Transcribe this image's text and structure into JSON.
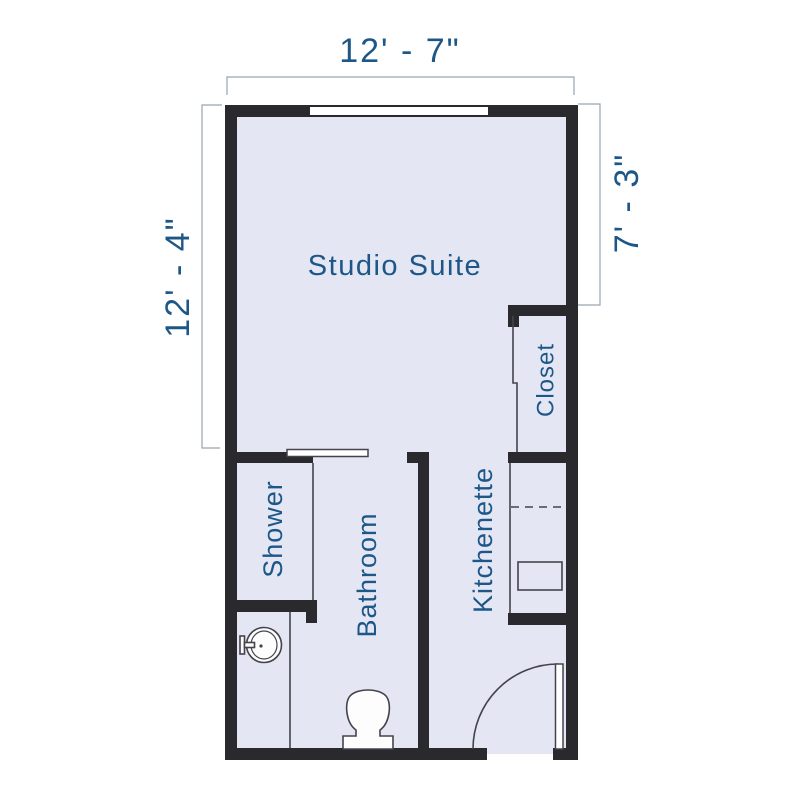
{
  "title": "Studio Suite Floor Plan",
  "colors": {
    "label": "#1d5787",
    "floor": "#e4e6f4",
    "wall": "#2a292d",
    "fixture_line": "#44434a",
    "dimension_line": "#9aa3b0",
    "background": "#ffffff"
  },
  "dimensions": {
    "top": "12' - 7\"",
    "left": "12' - 4\"",
    "right": "7' - 3\""
  },
  "rooms": {
    "studio": "Studio Suite",
    "closet": "Closet",
    "shower": "Shower",
    "bathroom": "Bathroom",
    "kitchenette": "Kitchenette"
  },
  "fixtures": [
    "window",
    "entry-door-swing",
    "shower-sliding-door",
    "closet-sliding-door",
    "bathroom-sink",
    "toilet",
    "kitchenette-counter",
    "kitchenette-appliance"
  ]
}
